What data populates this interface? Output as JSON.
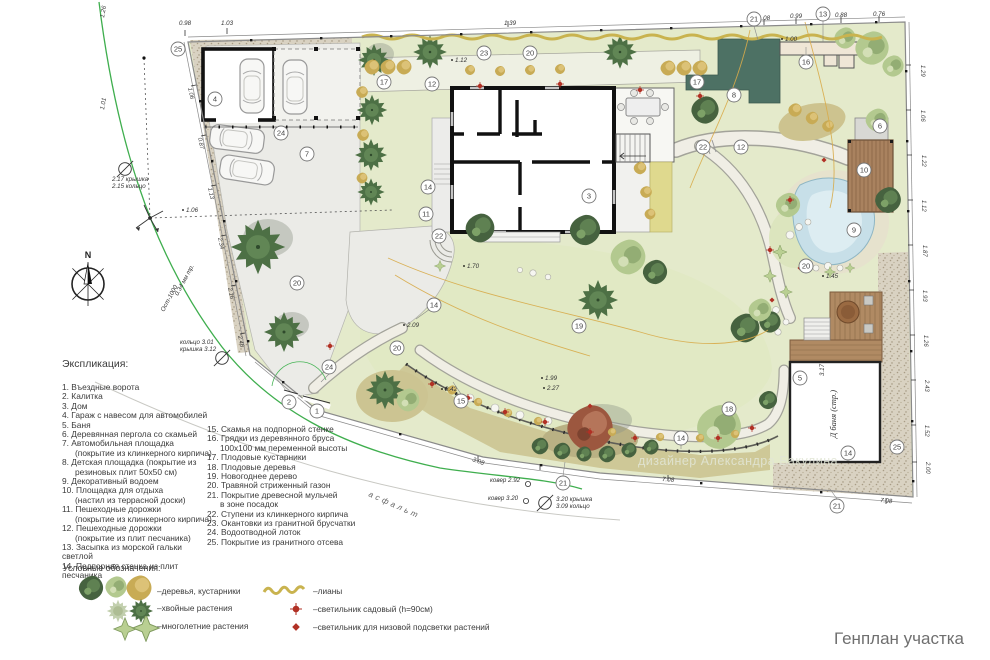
{
  "window": {
    "title": "Генплан участка"
  },
  "designer": "дизайнер Александра Бакулина",
  "compass": {
    "label": "N"
  },
  "explication": {
    "title": "Экспликация:",
    "col1": [
      {
        "t": "1. Въездные ворота"
      },
      {
        "t": "2. Калитка"
      },
      {
        "t": "3. Дом"
      },
      {
        "t": "4. Гараж с навесом для автомобилей"
      },
      {
        "t": "5. Баня"
      },
      {
        "t": "6. Деревянная пергола со скамьей"
      },
      {
        "t": "7. Автомобильная площадка",
        "t2": "(покрытие из клинкерного кирпича)"
      },
      {
        "t": "8. Детская площадка (покрытие из",
        "t2": "резиновых плит 50х50 см)"
      },
      {
        "t": "9. Декоративный водоем"
      },
      {
        "t": "10. Площадка для отдыха",
        "t2": "(настил из террасной доски)"
      },
      {
        "t": "11. Пешеходные дорожки",
        "t2": "(покрытие из клинкерного кирпича)"
      },
      {
        "t": "12. Пешеходные дорожки",
        "t2": "(покрытие из плит песчаника)"
      },
      {
        "t": "13. Засыпка из морской гальки светлой"
      },
      {
        "t": "14. Подпорная стенка из плит песчаника"
      }
    ],
    "col2": [
      {
        "t": "15. Скамья на подпорной стенке"
      },
      {
        "t": "16. Грядки из деревянного бруса",
        "t2": "100х100 мм переменной высоты"
      },
      {
        "t": "17. Плодовые кустарники"
      },
      {
        "t": "18. Плодовые деревья"
      },
      {
        "t": "19. Новогоднее дерево"
      },
      {
        "t": "20. Травяной стриженный газон"
      },
      {
        "t": "21. Покрытие древесной мульчей",
        "t2": "в зоне посадок"
      },
      {
        "t": "22. Ступени из клинкерного кирпича"
      },
      {
        "t": "23. Окантовки из гранитной брусчатки"
      },
      {
        "t": "24. Водоотводной лоток"
      },
      {
        "t": "25. Покрытие из гранитного отсева"
      }
    ]
  },
  "legend": {
    "title": "Условные обозначения:",
    "items": [
      {
        "icon": "trees-shrubs-icon",
        "label": "–деревья, кустарники"
      },
      {
        "icon": "conifer-plants-icon",
        "label": "–хвойные растения"
      },
      {
        "icon": "perennial-plants-icon",
        "label": "–многолетние растения"
      },
      {
        "icon": "lianas-icon",
        "label": "–лианы"
      },
      {
        "icon": "garden-lamp-icon",
        "label": "–светильник садовый (h=90см)"
      },
      {
        "icon": "low-light-lamp-icon",
        "label": "–светильник для низовой подсветки растений"
      }
    ]
  },
  "plan": {
    "markers": [
      "1",
      "2",
      "3",
      "4",
      "5",
      "6",
      "7",
      "8",
      "9",
      "10",
      "11",
      "12",
      "12",
      "13",
      "14",
      "14",
      "14",
      "14",
      "15",
      "16",
      "17",
      "17",
      "18",
      "19",
      "20",
      "20",
      "20",
      "20",
      "21",
      "21",
      "21",
      "22",
      "22",
      "23",
      "24",
      "24",
      "25",
      "25"
    ],
    "spots": [
      "1.70",
      "2.09",
      "1.99",
      "2.27",
      "2.42",
      "1.45",
      "1.12",
      "1.39",
      "0.98",
      "1.03",
      "0.76",
      "7.08",
      "7.08",
      "1.06",
      "1.00",
      "3.08",
      "1.08",
      "0.99",
      "0.88",
      "3.17",
      "1.26",
      "1.01"
    ],
    "dims_east": [
      "1.29",
      "1.06",
      "1.22",
      "1.12",
      "1.87",
      "1.93",
      "1.26",
      "2.43",
      "1.52",
      "2.00"
    ],
    "dims_west": [
      "1.06",
      "0.87",
      "1.13",
      "2.34",
      "2.16",
      "2.46"
    ],
    "labels": {
      "asphalt": "асфальт",
      "banya": "Д баня (стр.)",
      "manhole1a": "2.17 крышка",
      "manhole1b": "2.15 кольцо",
      "manhole2a": "кольцо 3.01",
      "manhole2b": "крышка 3.12",
      "manhole3a": "3.20 крышка",
      "manhole3b": "3.09 кольцо",
      "kover1": "ковер 2.92",
      "kover2": "ковер 3.20",
      "pipe1": "0.34 мм тр.",
      "pipe2": "Ост-1000"
    }
  }
}
